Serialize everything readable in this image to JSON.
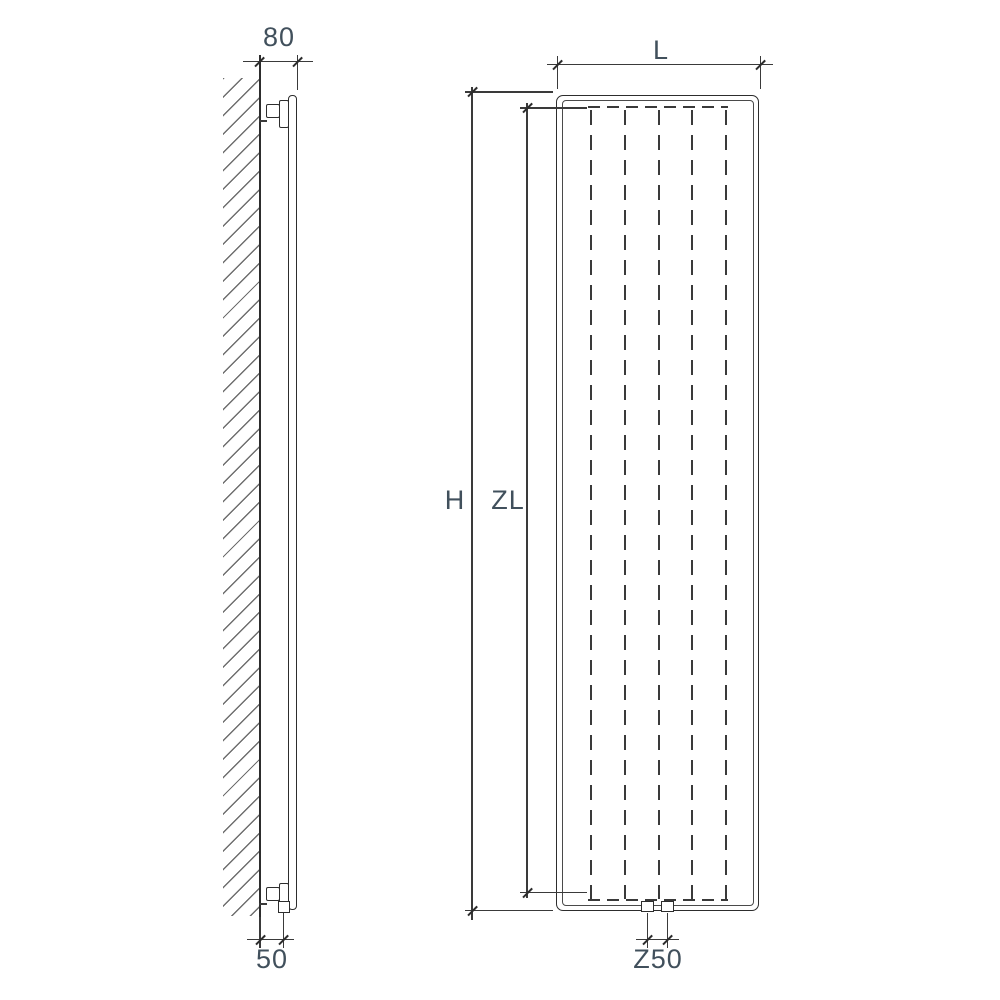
{
  "labels": {
    "dim_80": "80",
    "dim_50": "50",
    "dim_L": "L",
    "dim_H": "H",
    "dim_ZL": "ZL",
    "dim_Z50": "Z50"
  },
  "colors": {
    "background": "#ffffff",
    "line": "#3a3a3a",
    "text": "#41505c"
  }
}
